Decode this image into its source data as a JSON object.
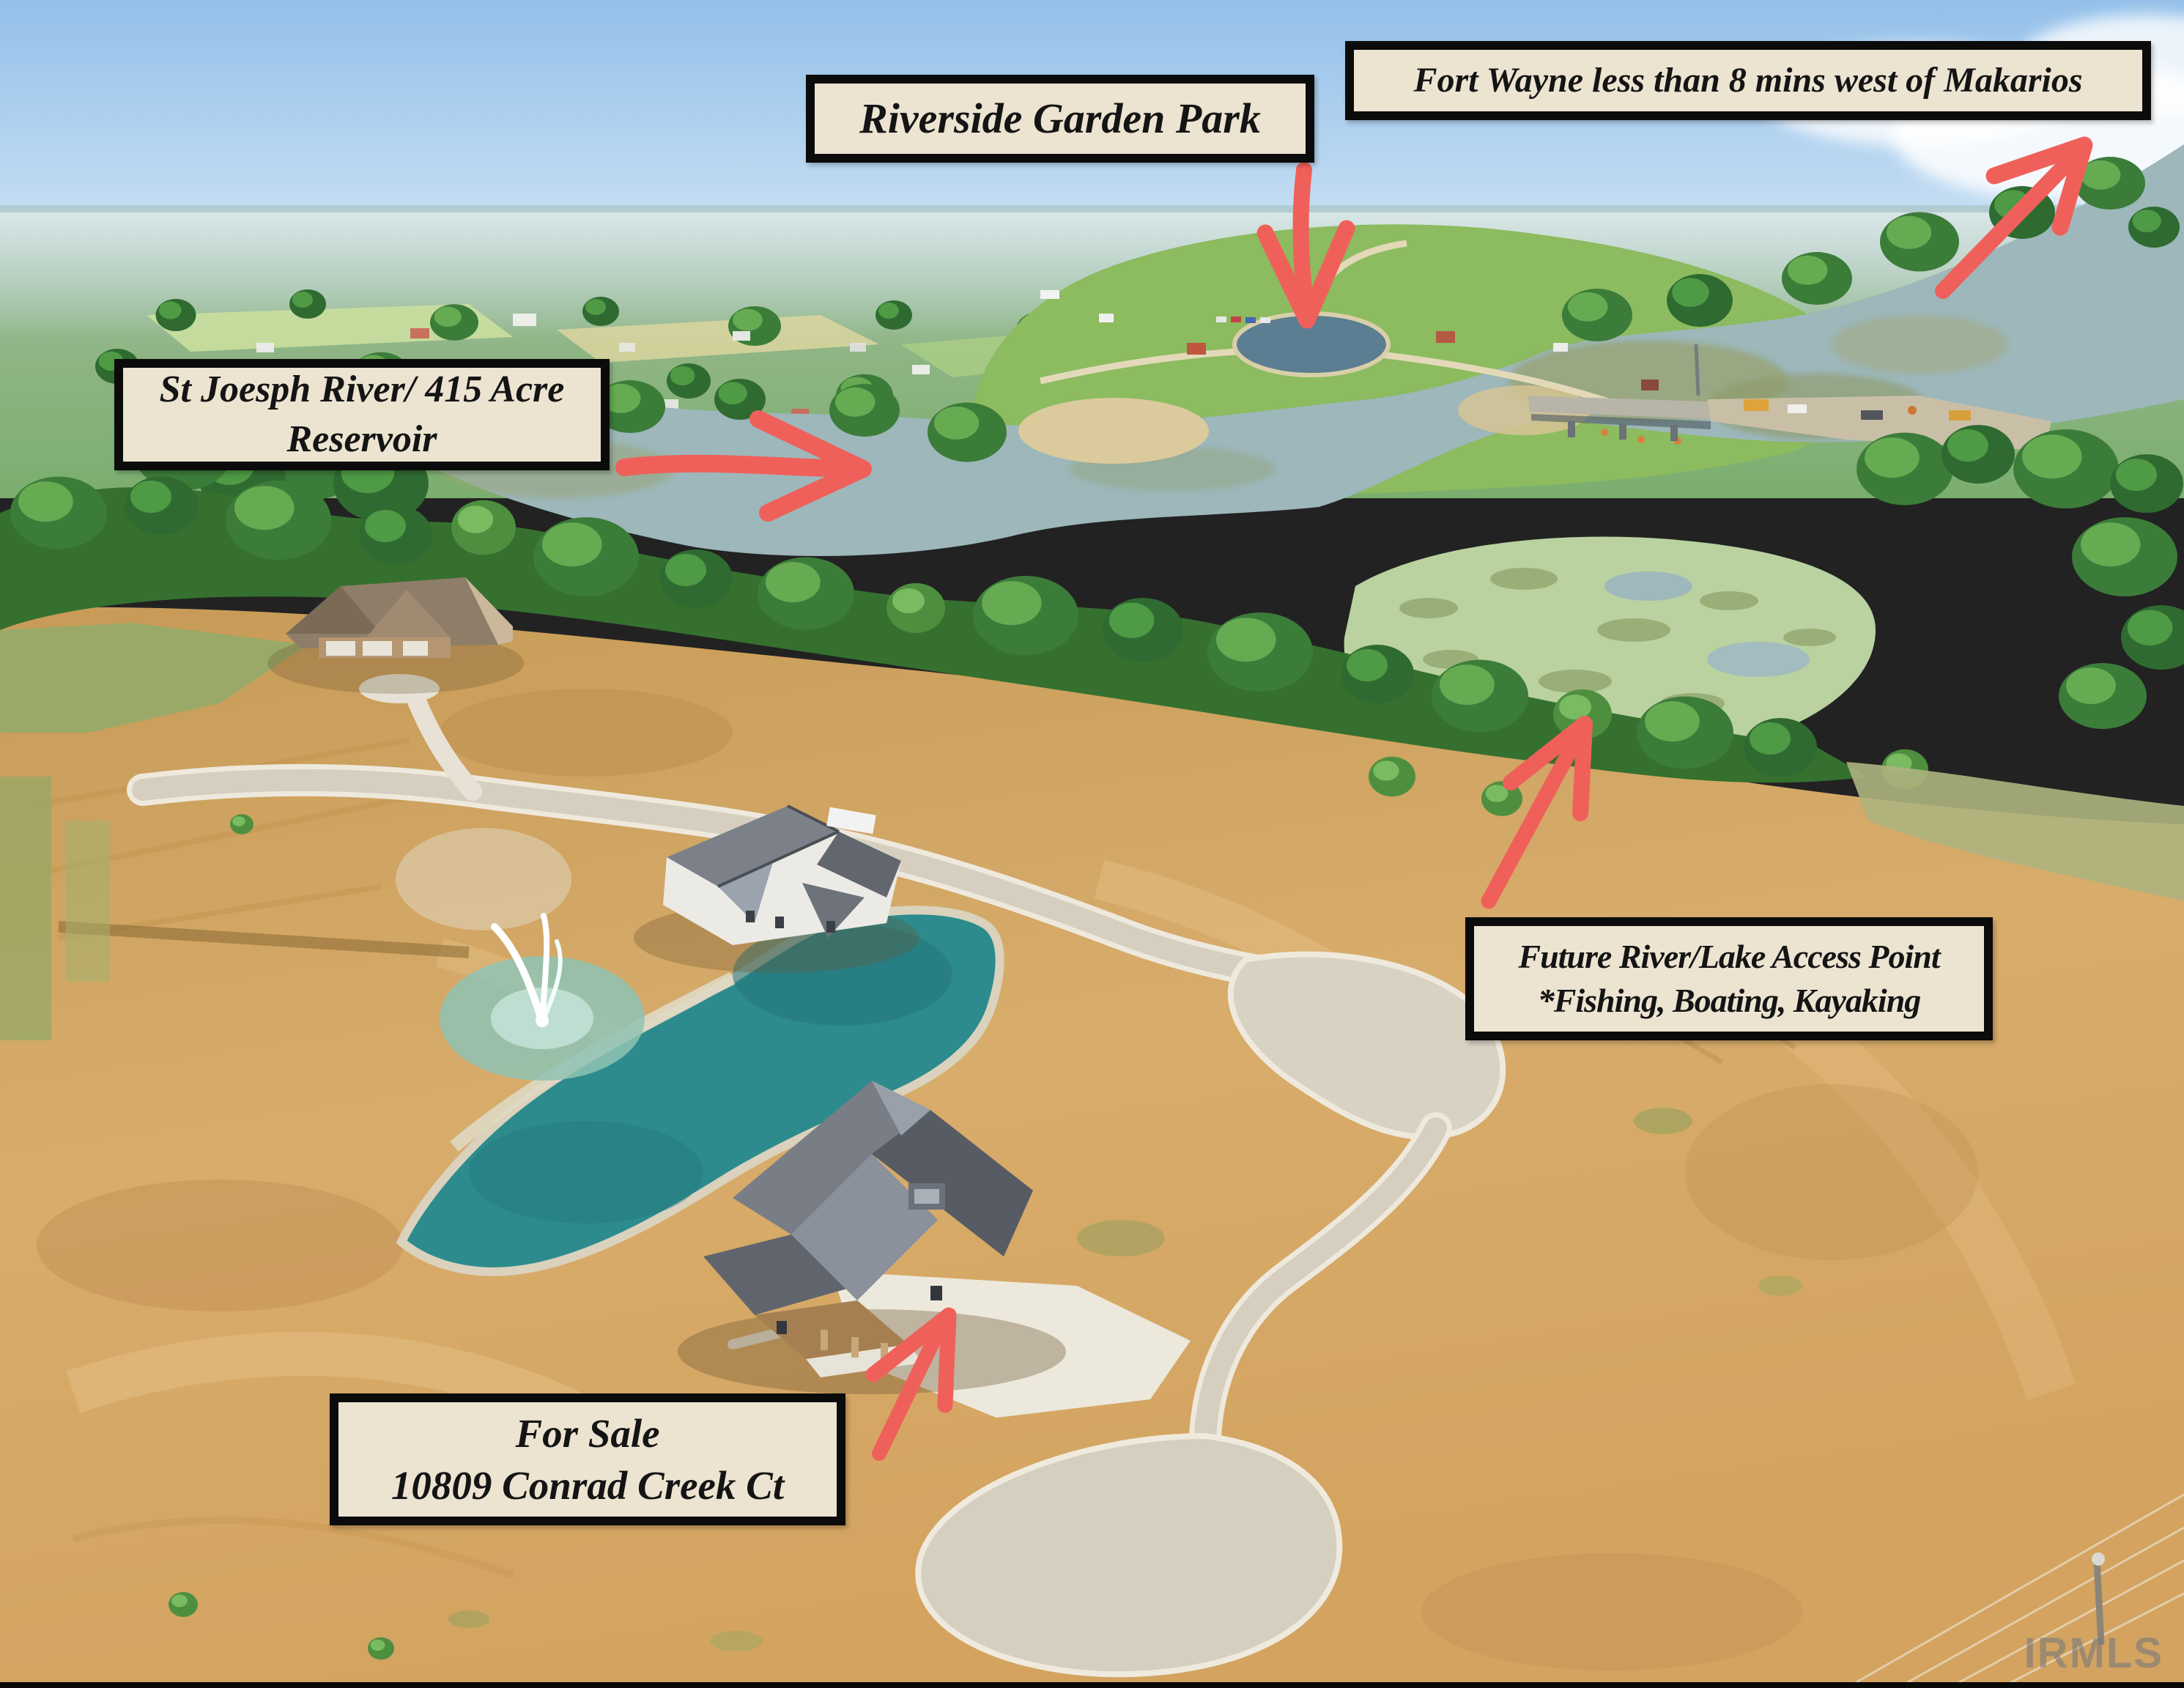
{
  "annotations": {
    "park": {
      "lines": [
        "Riverside Garden Park"
      ]
    },
    "fort_wayne": {
      "lines": [
        "Fort Wayne less than 8 mins west of Makarios"
      ]
    },
    "river": {
      "lines": [
        "St Joesph River/ 415 Acre",
        "Reservoir"
      ]
    },
    "access": {
      "lines": [
        "Future River/Lake Access Point",
        "*Fishing, Boating, Kayaking"
      ]
    },
    "for_sale": {
      "lines": [
        "For Sale",
        "10809 Conrad Creek Ct"
      ]
    }
  },
  "watermark": "IRMLS",
  "colors": {
    "annotation_arrow": "#f0605a",
    "annotation_box_bg": "#ece3d1",
    "annotation_box_border": "#0b0b0b",
    "sky": "#a9cfee",
    "river_water": "#9db7bb",
    "pond_water": "#2d8b8d",
    "park_lawn": "#8cbb60",
    "tree_canopy": "#35702f",
    "graded_dirt": "#d2a364",
    "road_pavement": "#ddd7c9"
  }
}
